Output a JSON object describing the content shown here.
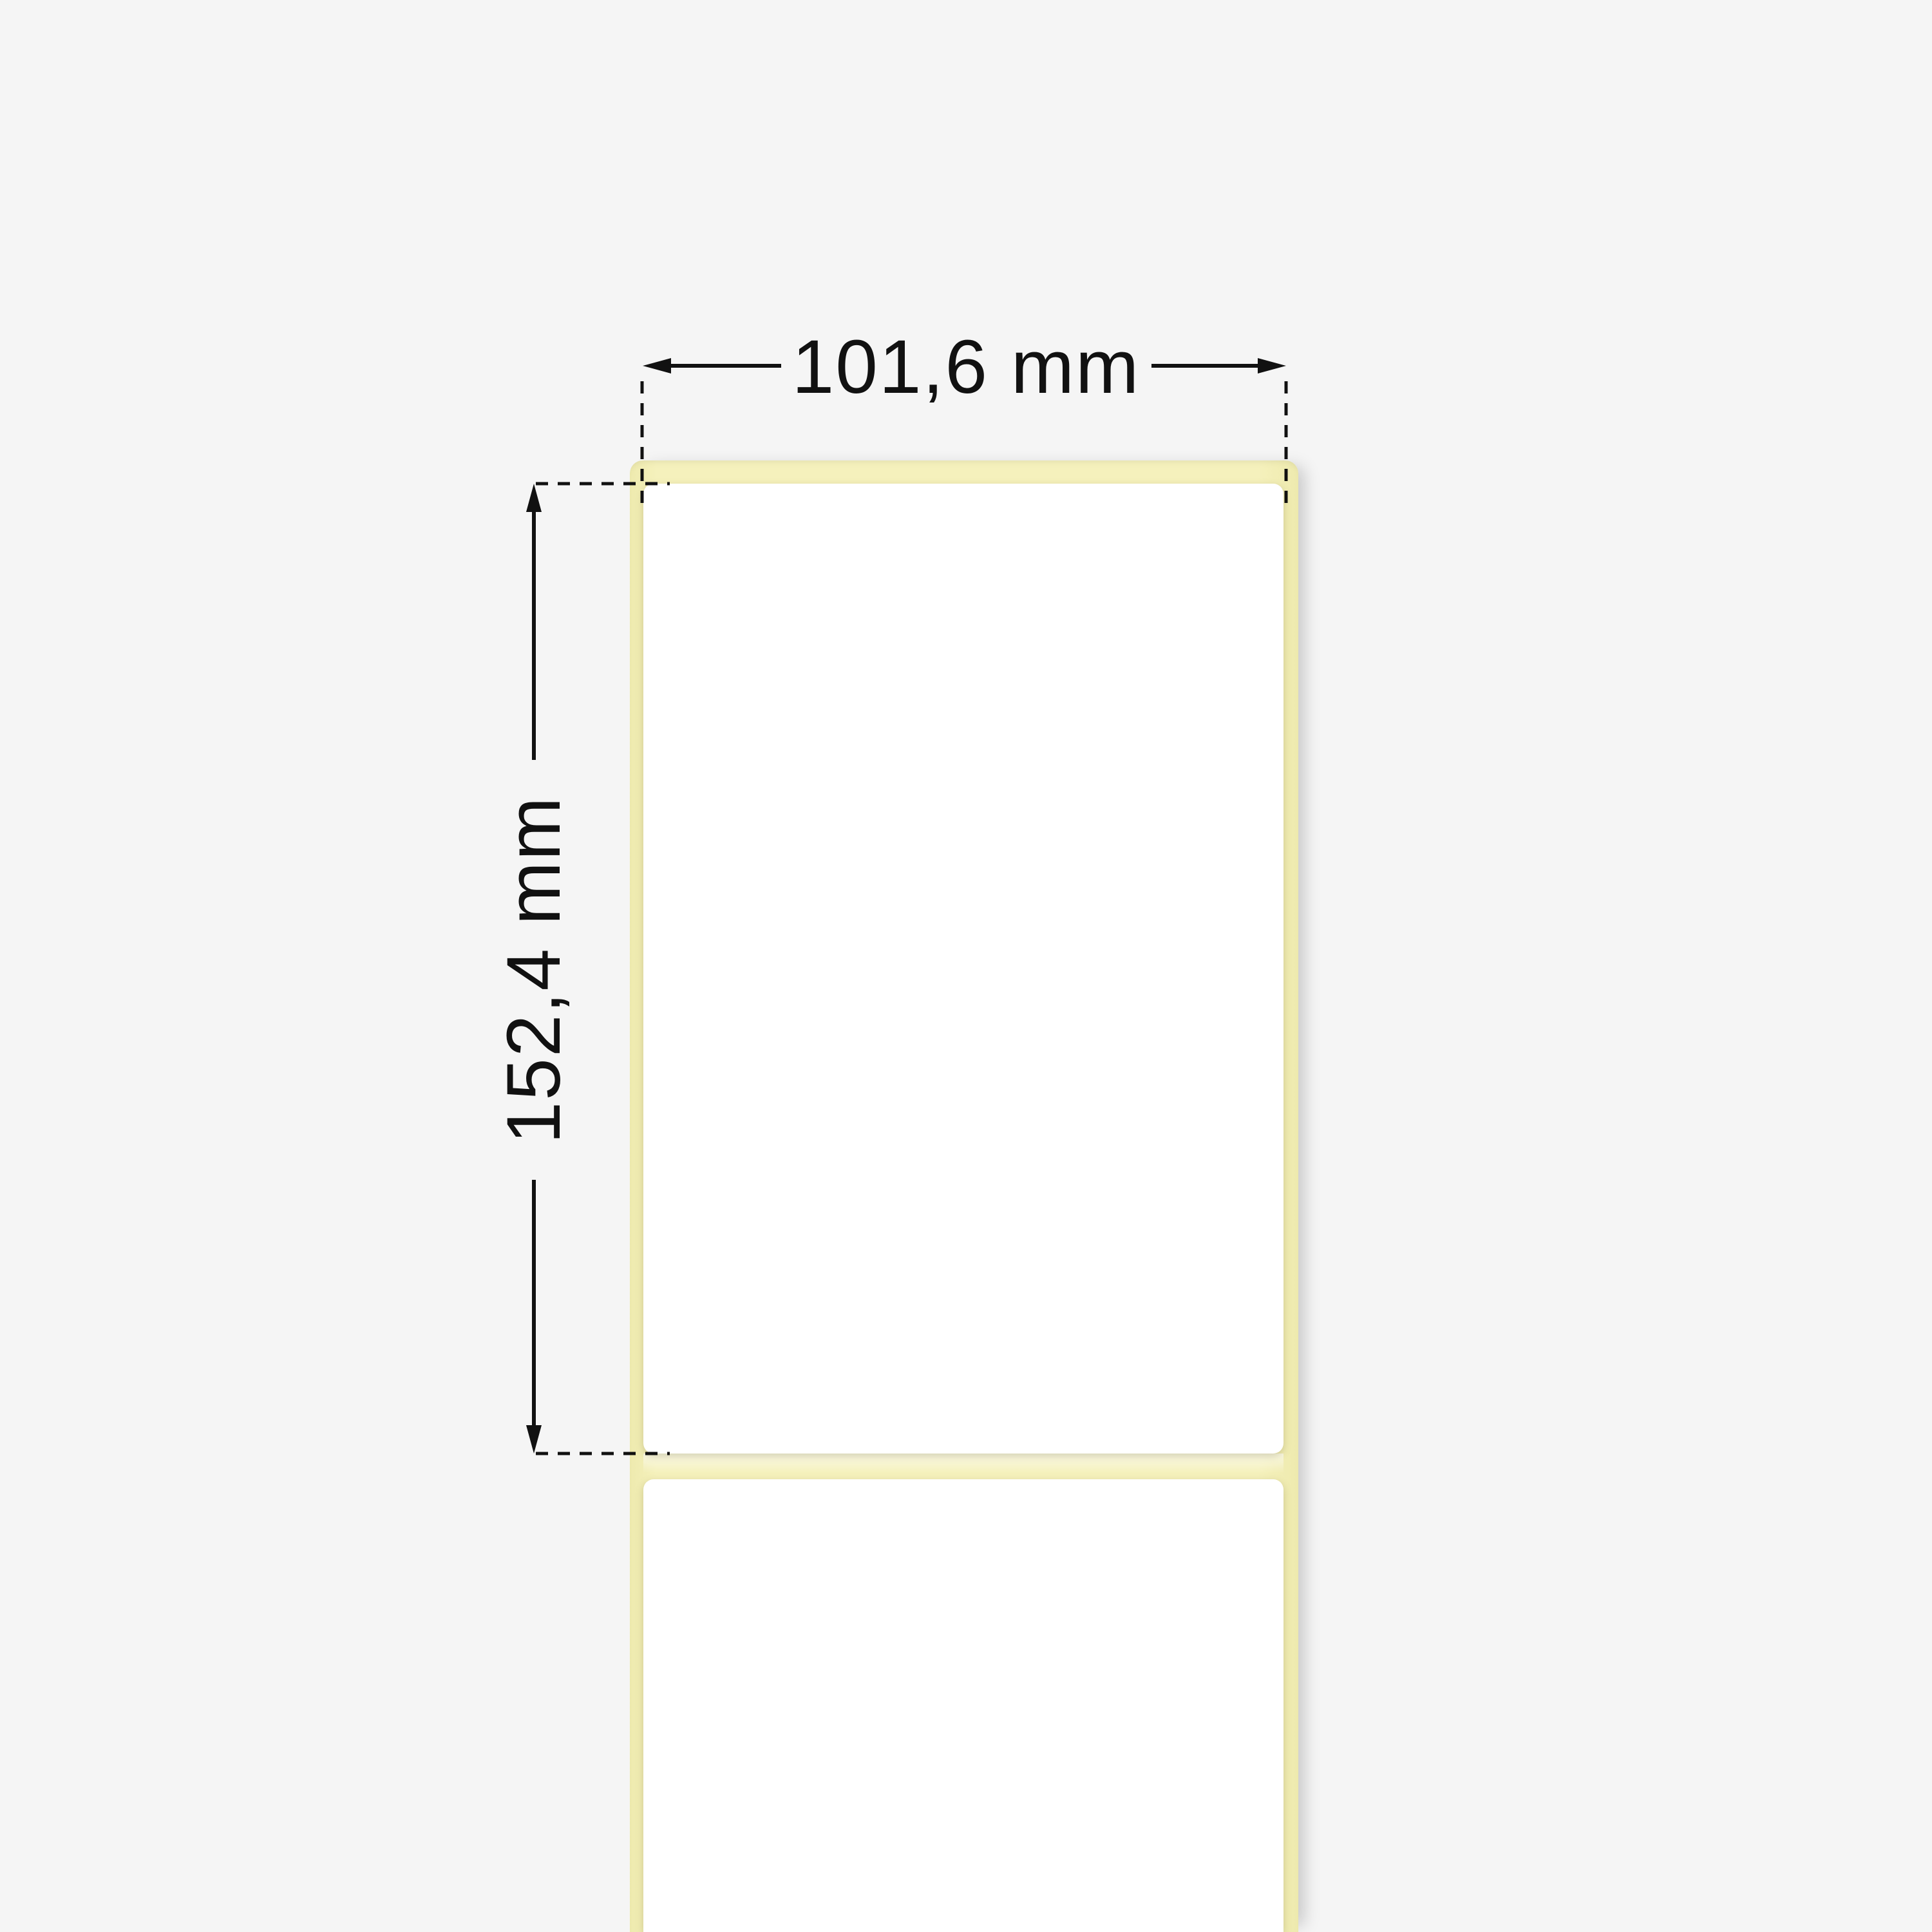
{
  "illustration": {
    "description": "Thermal transfer label roll with dimension annotations",
    "width_dimension": {
      "label": "101,6 mm"
    },
    "height_dimension": {
      "label": "152,4 mm"
    }
  },
  "colors": {
    "background": "#f5f5f5",
    "liner": "#f5f1bc",
    "liner_edge": "#eeeaae",
    "label": "#ffffff",
    "annotation": "#111111"
  }
}
